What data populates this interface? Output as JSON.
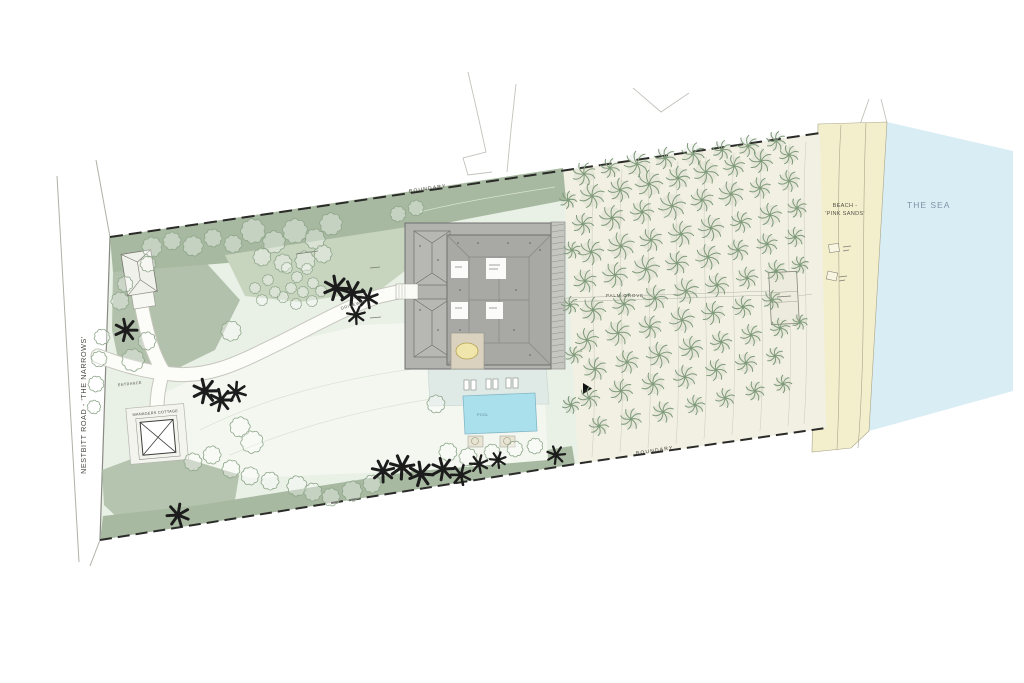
{
  "labels": {
    "road": "NESTBITT ROAD - 'THE NARROWS'",
    "boundary_top": "BOUNDARY",
    "boundary_bottom": "BOUNDARY",
    "palm_grove": "PALM GROVE",
    "beach_line1": "BEACH -",
    "beach_line2": "'PINK SANDS'",
    "sea": "THE SEA",
    "driveway": "DRIVEWAY",
    "entrance": "ENTRANCE",
    "cottage": "MANAGERS COTTAGE",
    "pool": "POOL"
  },
  "colors": {
    "ink": "#1c1c1c",
    "boundary": "#2a2a28",
    "tree": "#7f9a7a",
    "tree2": "#8ea68a",
    "sea": "#d9edf5",
    "beach": "#f3efcd",
    "beachEdge": "#a8a489",
    "lawn": "#e9f0e6",
    "grove": "#f1f0e3",
    "sage": "#a7b9a0",
    "sageMid": "#c7d5bf",
    "pale": "#f3f7f0",
    "roof": "#b2b2af",
    "roofDark": "#a8a8a5",
    "roofLine": "#6f6f6c",
    "pergola": "#c6c6c1",
    "pool": "#aadfec",
    "poolEdge": "#85b8c6",
    "terrace": "#dfe9e5",
    "patio": "#dad2bf",
    "table": "#f0e5ab",
    "path": "#fcfcf9",
    "pathEdge": "#c6c6bd",
    "contour": "#cdcdbe",
    "lawnContour": "#d9e3d3",
    "text": "#45453f",
    "seaText": "#7e94a6",
    "panel": "#f3f4ee",
    "white": "#fbfbf8"
  },
  "trees": {
    "grove_palms": [
      [
        584,
        174,
        12
      ],
      [
        610,
        168,
        10
      ],
      [
        637,
        164,
        13
      ],
      [
        665,
        158,
        11
      ],
      [
        693,
        154,
        12
      ],
      [
        722,
        150,
        10
      ],
      [
        748,
        146,
        11
      ],
      [
        776,
        141,
        10
      ],
      [
        592,
        196,
        13
      ],
      [
        620,
        190,
        12
      ],
      [
        649,
        184,
        14
      ],
      [
        678,
        178,
        12
      ],
      [
        706,
        172,
        13
      ],
      [
        734,
        166,
        11
      ],
      [
        761,
        161,
        12
      ],
      [
        789,
        155,
        10
      ],
      [
        583,
        224,
        11
      ],
      [
        612,
        218,
        13
      ],
      [
        642,
        212,
        12
      ],
      [
        672,
        206,
        14
      ],
      [
        702,
        200,
        12
      ],
      [
        731,
        194,
        13
      ],
      [
        760,
        188,
        11
      ],
      [
        789,
        181,
        11
      ],
      [
        591,
        252,
        13
      ],
      [
        621,
        246,
        14
      ],
      [
        651,
        240,
        12
      ],
      [
        681,
        234,
        13
      ],
      [
        711,
        228,
        13
      ],
      [
        741,
        222,
        11
      ],
      [
        770,
        215,
        12
      ],
      [
        797,
        208,
        10
      ],
      [
        585,
        281,
        12
      ],
      [
        615,
        275,
        13
      ],
      [
        646,
        269,
        14
      ],
      [
        677,
        263,
        12
      ],
      [
        708,
        257,
        13
      ],
      [
        738,
        250,
        11
      ],
      [
        767,
        244,
        11
      ],
      [
        795,
        237,
        10
      ],
      [
        593,
        310,
        13
      ],
      [
        624,
        304,
        12
      ],
      [
        655,
        298,
        13
      ],
      [
        686,
        291,
        13
      ],
      [
        717,
        285,
        12
      ],
      [
        747,
        278,
        11
      ],
      [
        776,
        271,
        11
      ],
      [
        800,
        265,
        9
      ],
      [
        587,
        340,
        12
      ],
      [
        618,
        333,
        13
      ],
      [
        650,
        327,
        12
      ],
      [
        682,
        320,
        13
      ],
      [
        713,
        313,
        12
      ],
      [
        743,
        307,
        11
      ],
      [
        772,
        300,
        10
      ],
      [
        595,
        369,
        12
      ],
      [
        627,
        362,
        12
      ],
      [
        659,
        355,
        13
      ],
      [
        691,
        348,
        12
      ],
      [
        721,
        342,
        11
      ],
      [
        751,
        335,
        11
      ],
      [
        780,
        328,
        10
      ],
      [
        800,
        322,
        8
      ],
      [
        589,
        398,
        11
      ],
      [
        621,
        391,
        12
      ],
      [
        653,
        384,
        12
      ],
      [
        685,
        377,
        12
      ],
      [
        716,
        370,
        11
      ],
      [
        746,
        363,
        11
      ],
      [
        775,
        356,
        9
      ],
      [
        599,
        426,
        10
      ],
      [
        631,
        419,
        11
      ],
      [
        663,
        412,
        11
      ],
      [
        695,
        405,
        10
      ],
      [
        725,
        398,
        10
      ],
      [
        755,
        391,
        10
      ],
      [
        783,
        384,
        9
      ],
      [
        568,
        200,
        9
      ],
      [
        572,
        250,
        9
      ],
      [
        570,
        305,
        9
      ],
      [
        574,
        355,
        9
      ],
      [
        571,
        405,
        9
      ]
    ],
    "black_palms": [
      [
        126,
        330,
        11
      ],
      [
        205,
        391,
        12
      ],
      [
        221,
        400,
        11
      ],
      [
        236,
        392,
        10
      ],
      [
        336,
        288,
        12
      ],
      [
        352,
        293,
        12
      ],
      [
        368,
        298,
        10
      ],
      [
        356,
        315,
        9
      ],
      [
        383,
        471,
        11
      ],
      [
        402,
        467,
        12
      ],
      [
        421,
        474,
        12
      ],
      [
        443,
        469,
        11
      ],
      [
        461,
        475,
        10
      ],
      [
        479,
        464,
        9
      ],
      [
        178,
        515,
        11
      ],
      [
        556,
        455,
        9
      ],
      [
        498,
        460,
        8
      ]
    ],
    "round_trees": [
      [
        152,
        247,
        9
      ],
      [
        172,
        241,
        8
      ],
      [
        193,
        246,
        9
      ],
      [
        213,
        238,
        8
      ],
      [
        233,
        244,
        8
      ],
      [
        148,
        264,
        7
      ],
      [
        253,
        231,
        11
      ],
      [
        274,
        242,
        10
      ],
      [
        295,
        231,
        11
      ],
      [
        315,
        239,
        9
      ],
      [
        331,
        224,
        10
      ],
      [
        262,
        257,
        8
      ],
      [
        283,
        263,
        8
      ],
      [
        305,
        261,
        9
      ],
      [
        323,
        254,
        8
      ],
      [
        231,
        331,
        9
      ],
      [
        133,
        360,
        10
      ],
      [
        147,
        341,
        8
      ],
      [
        120,
        301,
        8
      ],
      [
        125,
        284,
        7
      ],
      [
        240,
        427,
        9
      ],
      [
        252,
        442,
        10
      ],
      [
        231,
        469,
        8
      ],
      [
        250,
        476,
        8
      ],
      [
        270,
        481,
        8
      ],
      [
        297,
        486,
        9
      ],
      [
        313,
        492,
        8
      ],
      [
        331,
        497,
        8
      ],
      [
        352,
        491,
        9
      ],
      [
        372,
        484,
        8
      ],
      [
        212,
        455,
        8
      ],
      [
        193,
        462,
        8
      ],
      [
        102,
        337,
        7
      ],
      [
        99,
        359,
        7
      ],
      [
        96,
        384,
        7
      ],
      [
        94,
        407,
        6
      ],
      [
        436,
        404,
        8
      ],
      [
        448,
        452,
        8
      ],
      [
        468,
        457,
        8
      ],
      [
        492,
        452,
        7
      ],
      [
        515,
        449,
        7
      ],
      [
        535,
        446,
        7
      ],
      [
        398,
        214,
        7
      ],
      [
        416,
        208,
        7
      ]
    ],
    "shrubs": [
      [
        287,
        268
      ],
      [
        297,
        277
      ],
      [
        307,
        269
      ],
      [
        291,
        288
      ],
      [
        303,
        292
      ],
      [
        313,
        283
      ],
      [
        321,
        291
      ],
      [
        283,
        297
      ],
      [
        296,
        304
      ],
      [
        312,
        301
      ],
      [
        268,
        280
      ],
      [
        275,
        292
      ],
      [
        262,
        300
      ],
      [
        255,
        288
      ]
    ]
  }
}
